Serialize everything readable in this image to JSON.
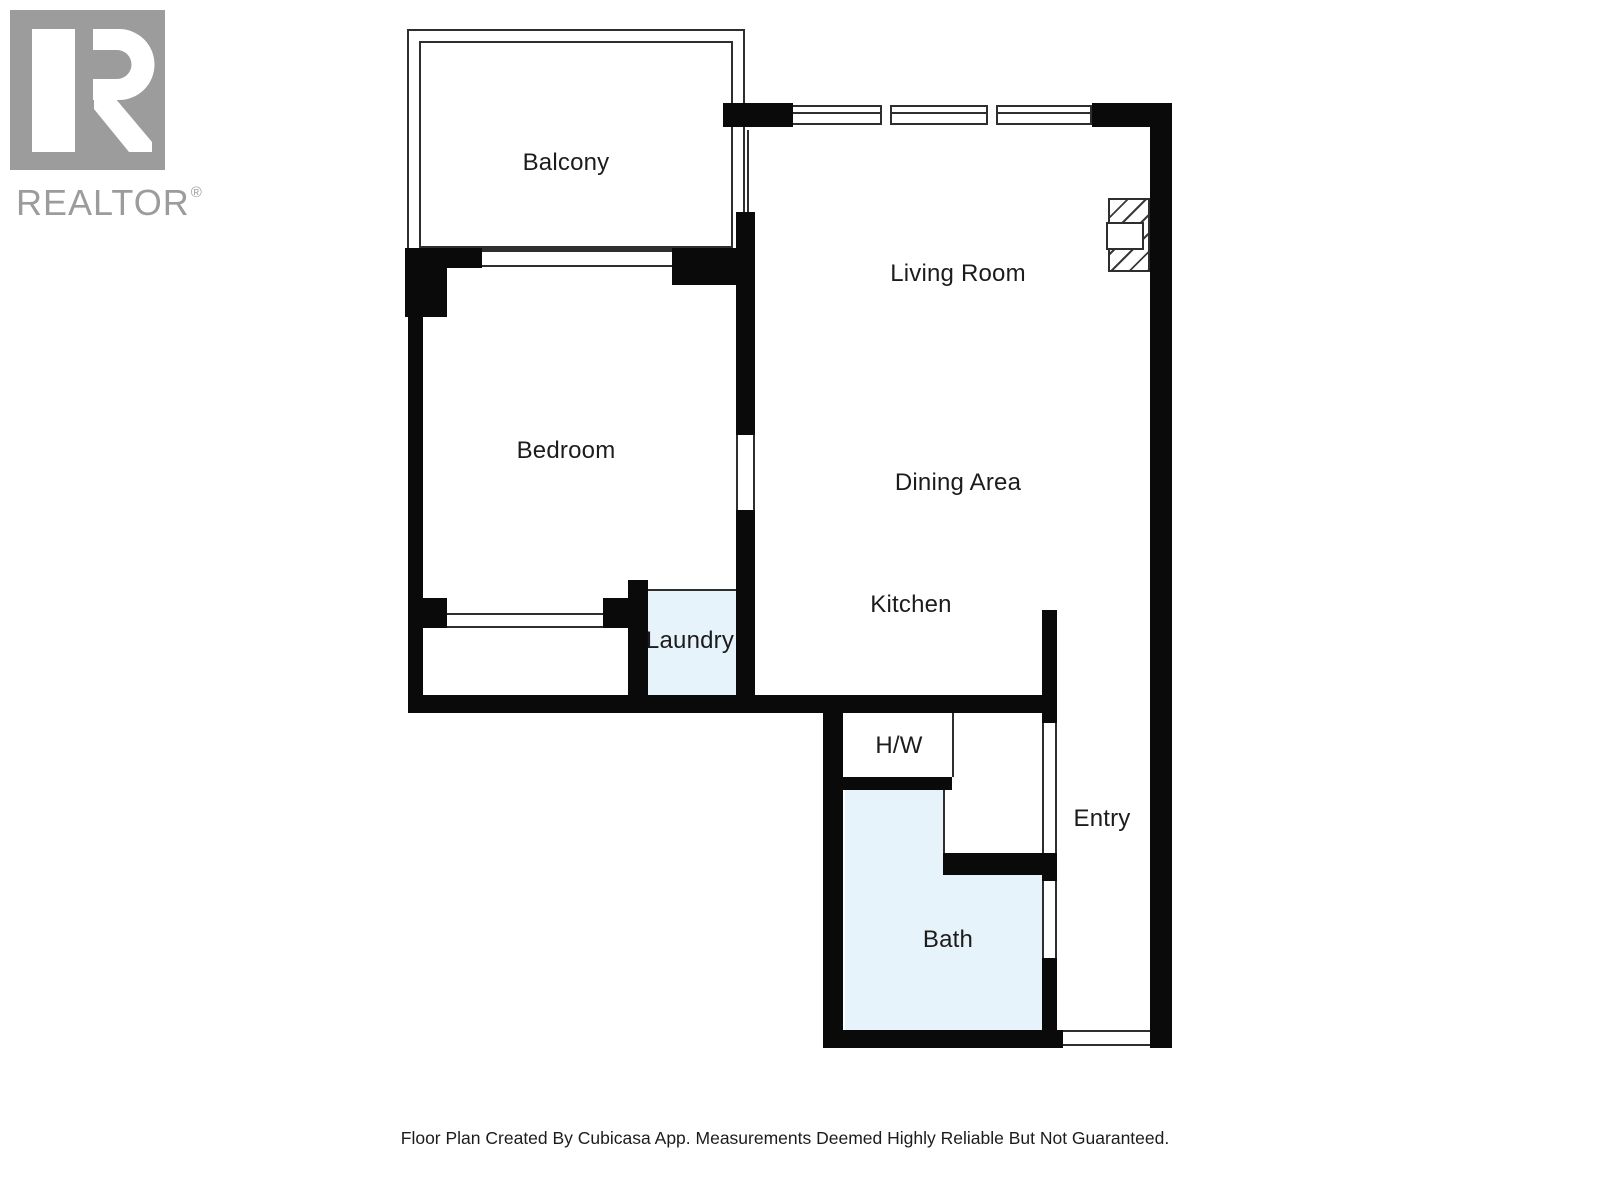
{
  "logo": {
    "brand": "REALTOR",
    "registered_mark": "®"
  },
  "plan": {
    "rooms": [
      {
        "name": "balcony",
        "label": "Balcony"
      },
      {
        "name": "living-room",
        "label": "Living Room"
      },
      {
        "name": "bedroom",
        "label": "Bedroom"
      },
      {
        "name": "dining-area",
        "label": "Dining Area"
      },
      {
        "name": "kitchen",
        "label": "Kitchen"
      },
      {
        "name": "laundry",
        "label": "Laundry"
      },
      {
        "name": "hot-water",
        "label": "H/W"
      },
      {
        "name": "entry",
        "label": "Entry"
      },
      {
        "name": "bath",
        "label": "Bath"
      }
    ],
    "colors": {
      "wall": "#0a0a0a",
      "wet_area_fill": "#e7f3fb",
      "thin_line": "#2e2e2e",
      "label_text": "#1c1c1c",
      "logo_gray": "#9c9c9c"
    }
  },
  "footer": {
    "disclaimer": "Floor Plan Created By Cubicasa App. Measurements Deemed Highly Reliable But Not Guaranteed."
  }
}
